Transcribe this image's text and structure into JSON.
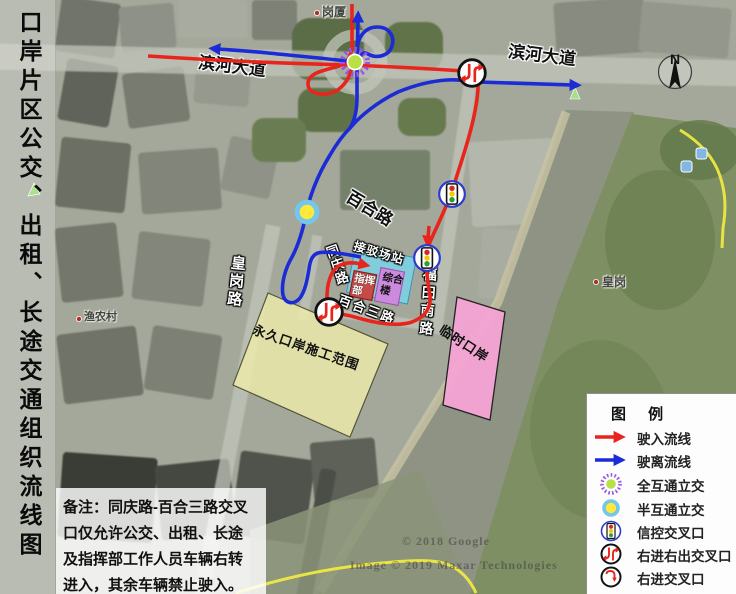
{
  "title": "口岸片区公交、出租、长途交通组织流线图",
  "map_labels": {
    "binhe_left": "滨河大道",
    "binhe_right": "滨河大道",
    "baihe_road": "百合路",
    "huanggang_road": "皇岗路",
    "tongqing_road": "同庆路",
    "futian_south_road": "福田南路",
    "baihe_3rd_road": "百合三路",
    "gangxia": "岗厦",
    "huanggang": "皇岗",
    "yunong": "渔农村"
  },
  "areas": {
    "station": "接驳场站",
    "command_post": "指挥部",
    "complex_building": "综合楼",
    "permanent_port": "永久口岸施工范围",
    "temporary_port": "临时口岸"
  },
  "compass": {
    "north_label": "N"
  },
  "legend": {
    "title": "图 例",
    "items": [
      {
        "icon": "inbound-arrow",
        "label": "驶入流线"
      },
      {
        "icon": "outbound-arrow",
        "label": "驶离流线"
      },
      {
        "icon": "full-interchange",
        "label": "全互通立交"
      },
      {
        "icon": "half-interchange",
        "label": "半互通立交"
      },
      {
        "icon": "signal-intersection",
        "label": "信控交叉口"
      },
      {
        "icon": "right-in-right-out",
        "label": "右进右出交叉口"
      },
      {
        "icon": "right-in",
        "label": "右进交叉口"
      }
    ]
  },
  "note": {
    "lines": [
      "备注：同庆路-百合三路交叉",
      "口仅允许公交、出租、长途",
      "及指挥部工作人员车辆右转",
      "进入，其余车辆禁止驶入。"
    ]
  },
  "watermarks": {
    "google": "© 2018 Google",
    "maxar": "Image © 2019 Maxar Technologies"
  },
  "colors": {
    "inbound_line": "#e8251c",
    "outbound_line": "#1b2bd6",
    "full_interchange_center": "#b9e145",
    "full_interchange_ring": "#9a55e8",
    "half_interchange_center": "#ffe93a",
    "half_interchange_ring": "#74c6ea",
    "permanent_port_fill": "#edecab",
    "temporary_port_fill": "#f6a3d4",
    "station_fill": "#7ed0e4",
    "command_fill": "#c64a45",
    "complex_fill": "#cb8add",
    "boundary_line": "#f2ec3f"
  }
}
